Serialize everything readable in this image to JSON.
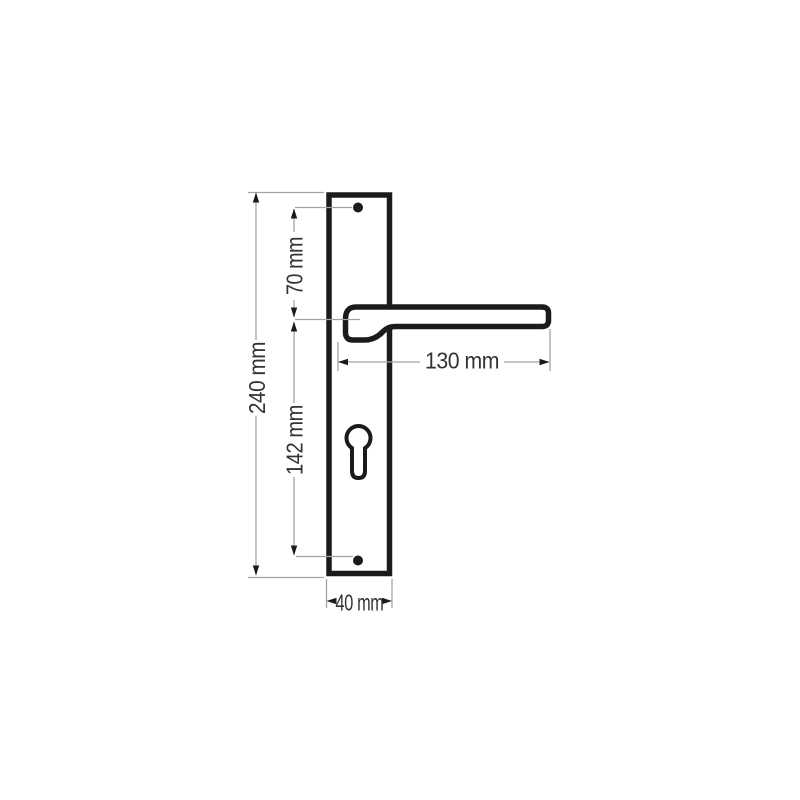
{
  "drawing": {
    "subject": "Door handle with long backplate - dimensioned technical drawing",
    "unit": "mm",
    "parts": {
      "backplate": "backplate",
      "lever_handle": "lever-handle",
      "keyhole": "euro-cylinder-keyhole",
      "screw_hole_top": "screw-hole-top",
      "screw_hole_bottom": "screw-hole-bottom"
    },
    "dimensions": {
      "overall_height": {
        "label": "240 mm",
        "value": 240
      },
      "top_screw_to_handle_axis": {
        "label": "70 mm",
        "value": 70
      },
      "handle_axis_to_bottom_screw": {
        "label": "142 mm",
        "value": 142
      },
      "handle_length": {
        "label": "130 mm",
        "value": 130
      },
      "plate_width": {
        "label": "40 mm",
        "value": 40
      }
    },
    "colors": {
      "outline": "#1b1b1b",
      "dimension_lines": "#a3a3a3",
      "arrowheads": "#1b1b1b",
      "text": "#333333",
      "background": "#ffffff"
    }
  }
}
